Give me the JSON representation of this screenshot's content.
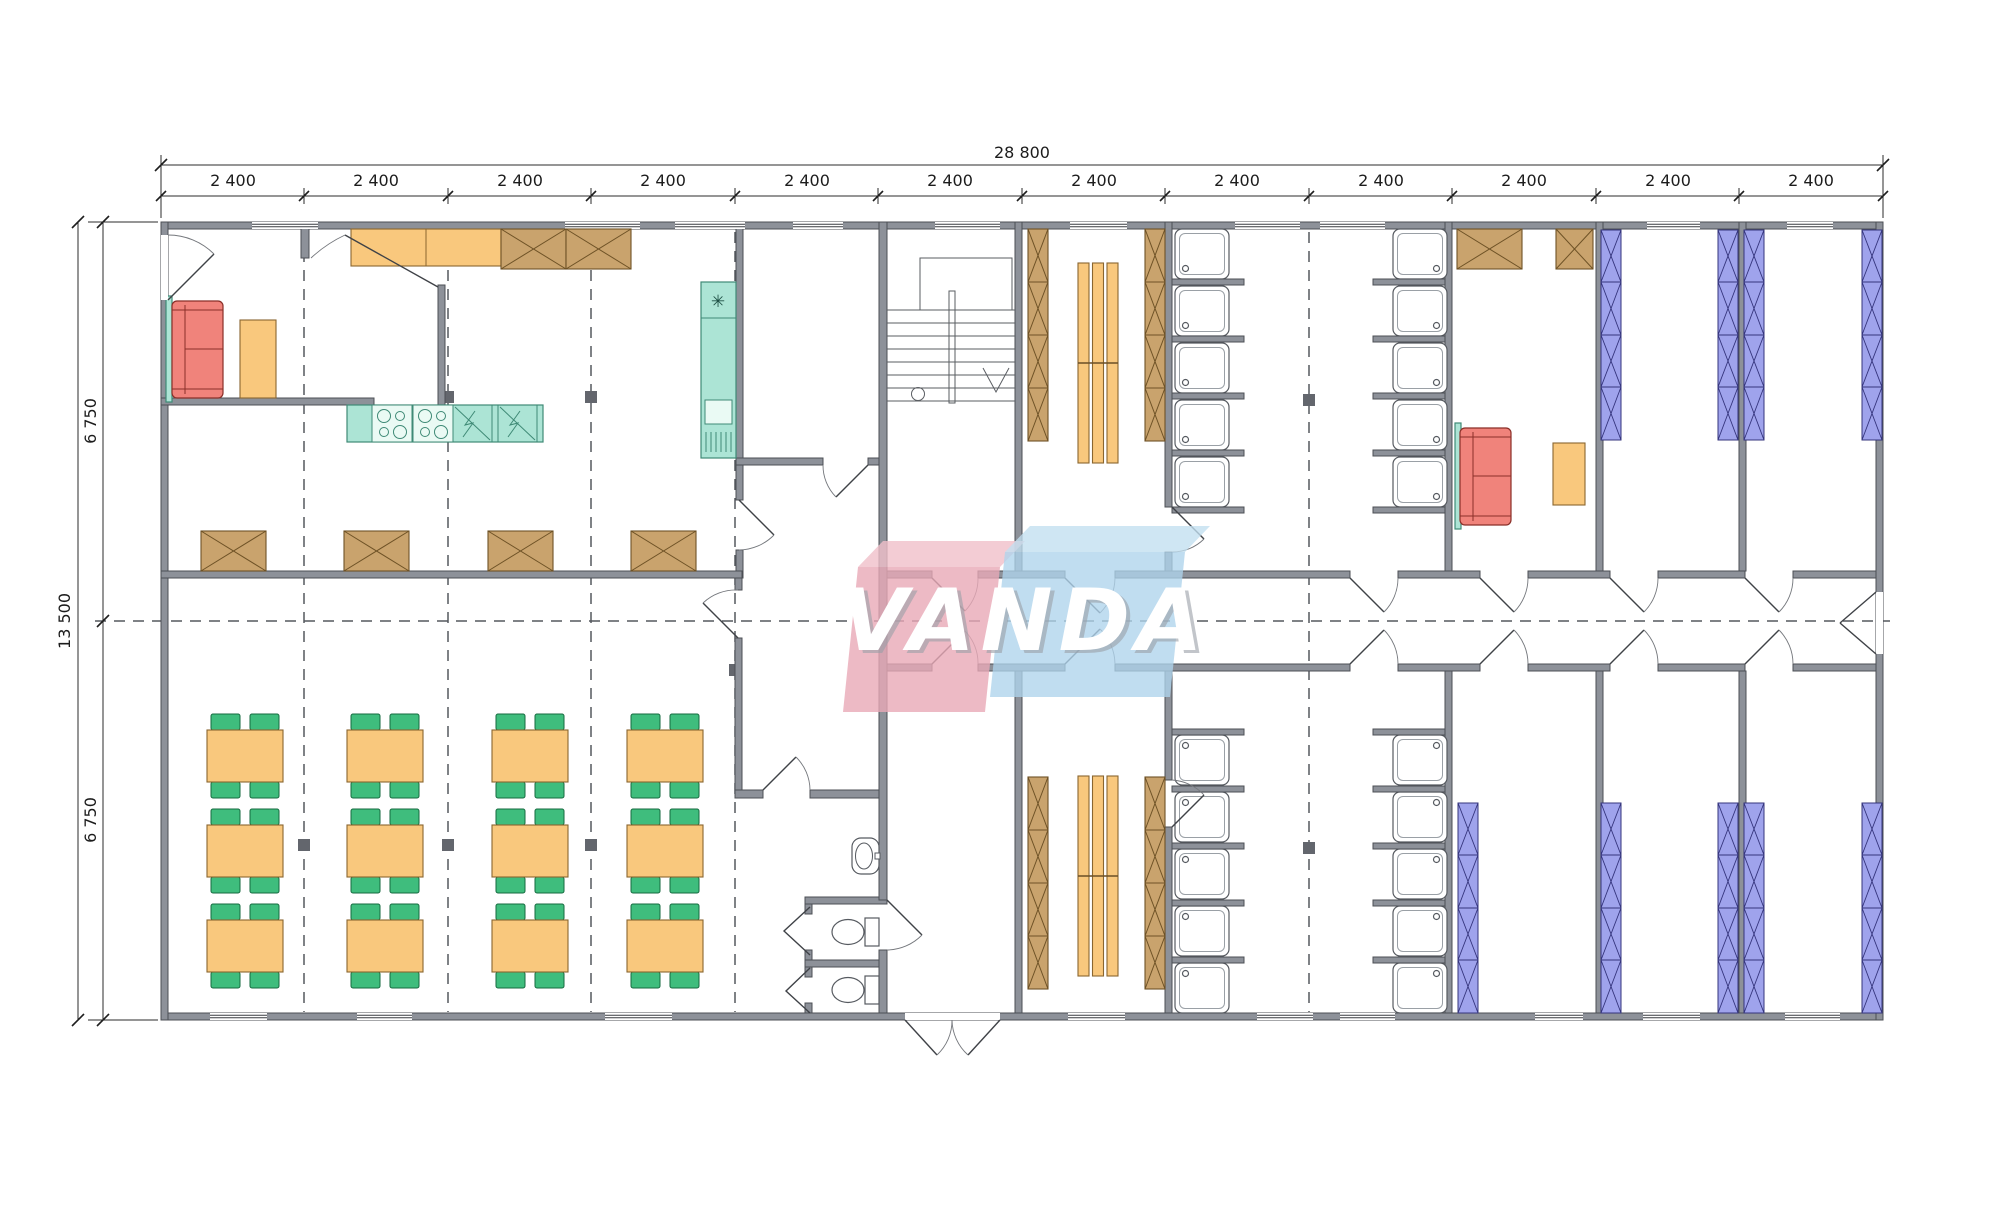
{
  "meta": {
    "drawing_type": "architectural floor plan",
    "background": "#ffffff"
  },
  "watermark": {
    "text": "VANDA",
    "pink_block": "#e8a9b6",
    "blue_block": "#aed3ec",
    "letter_color": "#ffffff"
  },
  "dimensions": {
    "total_width": "28 800",
    "bays": [
      "2 400",
      "2 400",
      "2 400",
      "2 400",
      "2 400",
      "2 400",
      "2 400",
      "2 400",
      "2 400",
      "2 400",
      "2 400",
      "2 400"
    ],
    "total_height": "13 500",
    "upper_half": "6 750",
    "lower_half": "6 750"
  },
  "symbols": {
    "freezer": "✳"
  },
  "palette": {
    "wall": "#8d9199",
    "wood_locker": "#c9a36d",
    "furniture_orange": "#f9c87d",
    "kitchen_teal": "#ace4d5",
    "sofa_red": "#f0837b",
    "bunk_blue": "#9fa3ec",
    "chair_green": "#3fbd7d"
  },
  "inventory": {
    "dining_tables": 12,
    "chairs": 48,
    "shower_stalls": 20,
    "toilets": 2,
    "washbasins": 1,
    "bunk_bed_units": 9,
    "locker_banks": 4,
    "benches": 2,
    "sofas": 2,
    "stoves": 2,
    "sinks": 2,
    "fridges": 1,
    "stairs": 1
  }
}
